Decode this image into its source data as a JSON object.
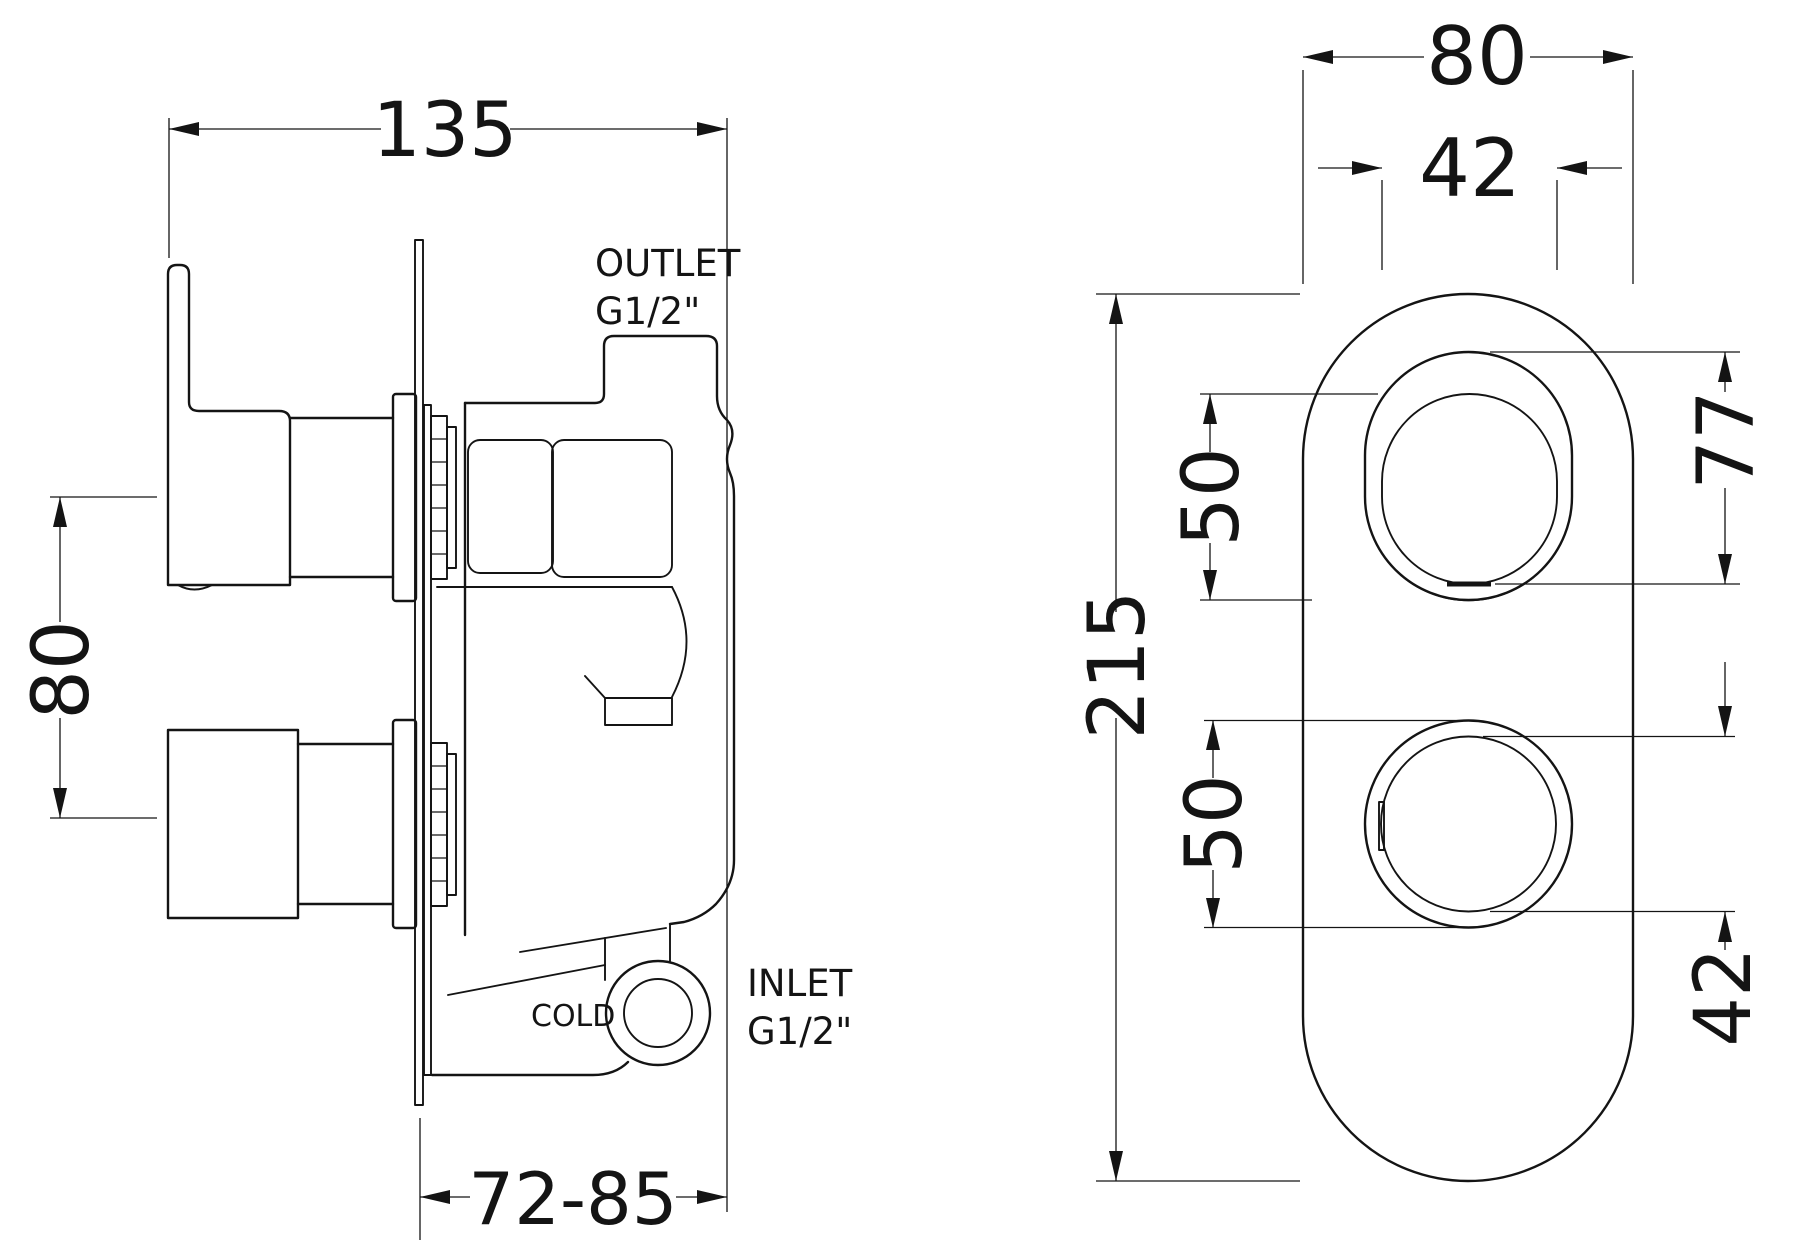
{
  "colors": {
    "ink": "#141414",
    "background": "#ffffff"
  },
  "side_view": {
    "dim_width": "135",
    "dim_handle_spacing": "80",
    "dim_depth_range": "72-85",
    "outlet_label": "OUTLET",
    "outlet_thread": "G1/2\"",
    "inlet_label": "INLET",
    "inlet_thread": "G1/2\"",
    "cold_label": "COLD"
  },
  "front_view": {
    "dim_plate_width": "80",
    "dim_slot_width": "42",
    "dim_plate_height": "215",
    "dim_lever_base_dia": "50",
    "dim_knob_dia": "50",
    "dim_slot_height": "77",
    "dim_knob_face_dia": "42"
  }
}
